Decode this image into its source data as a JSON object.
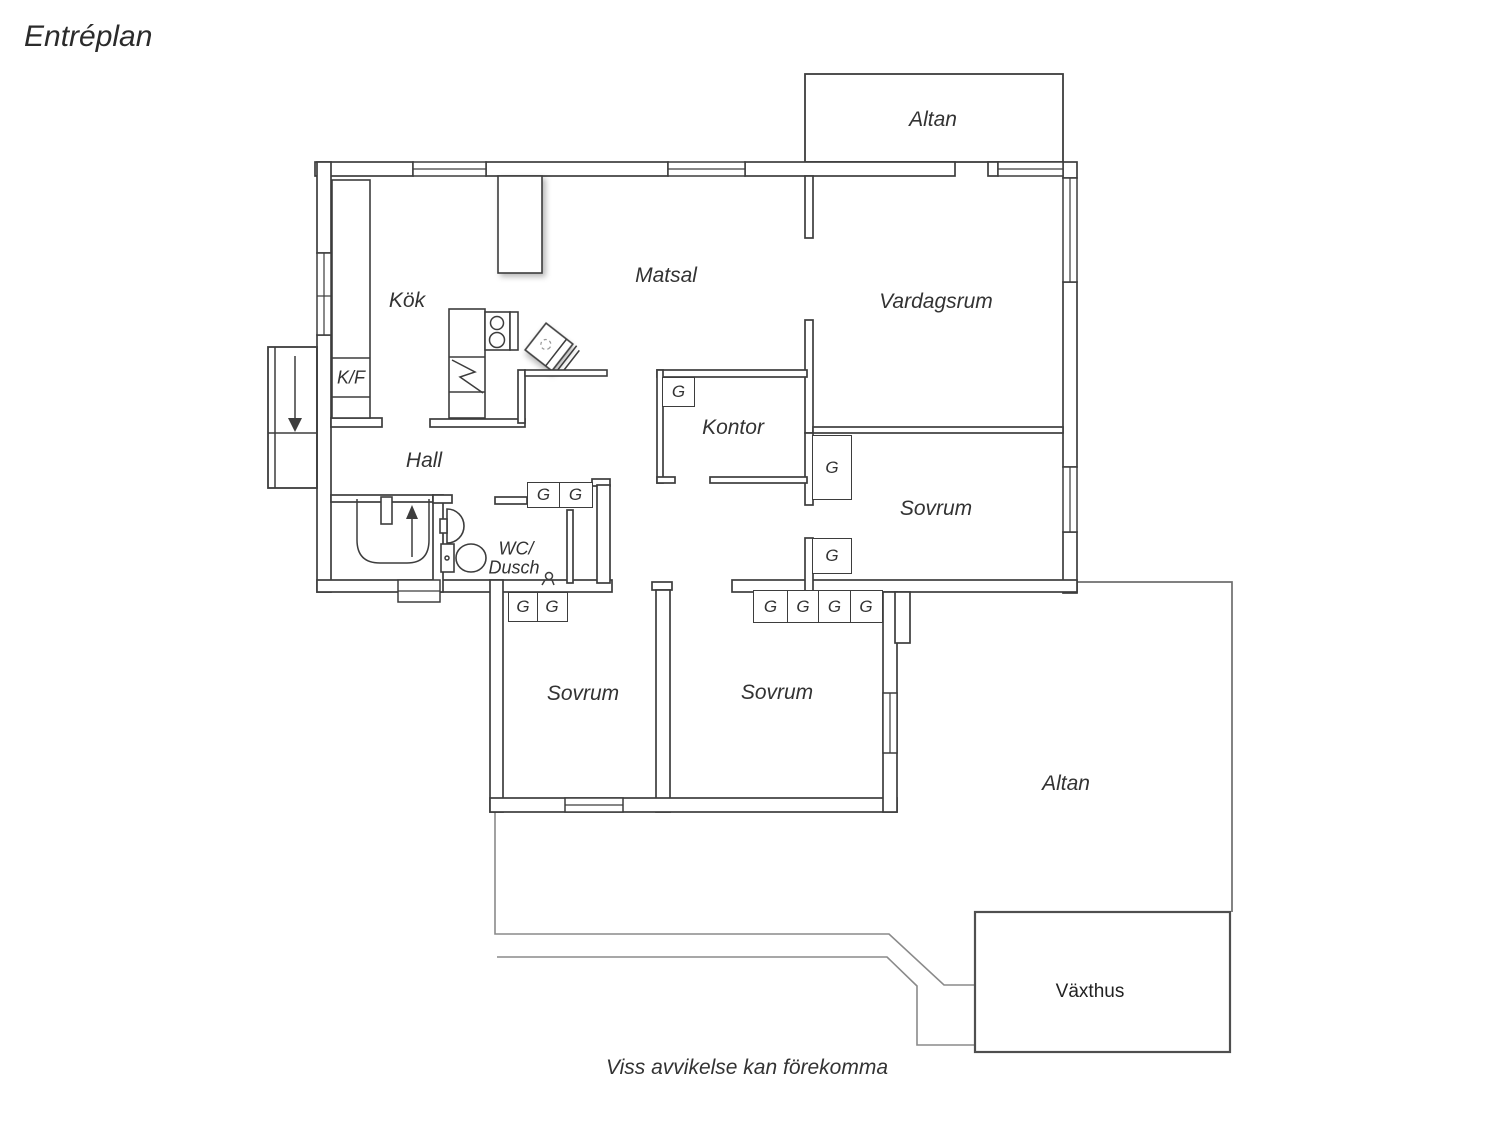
{
  "page": {
    "title": "Entréplan",
    "footer_note": "Viss avvikelse kan förekomma"
  },
  "plan": {
    "wardrobe_label": "G",
    "rooms": {
      "altan_top": "Altan",
      "kok": "Kök",
      "kf": "K/F",
      "matsal": "Matsal",
      "vardagsrum": "Vardagsrum",
      "kontor": "Kontor",
      "hall": "Hall",
      "wc_line1": "WC/",
      "wc_line2": "Dusch",
      "sovrum_mid": "Sovrum",
      "sovrum_left": "Sovrum",
      "sovrum_right": "Sovrum",
      "altan_bottom": "Altan",
      "vaxthus": "Växthus"
    },
    "colors": {
      "wall": "#3d3d3d",
      "deck": "#8a8a8a",
      "background": "#ffffff",
      "text": "#333333"
    }
  }
}
